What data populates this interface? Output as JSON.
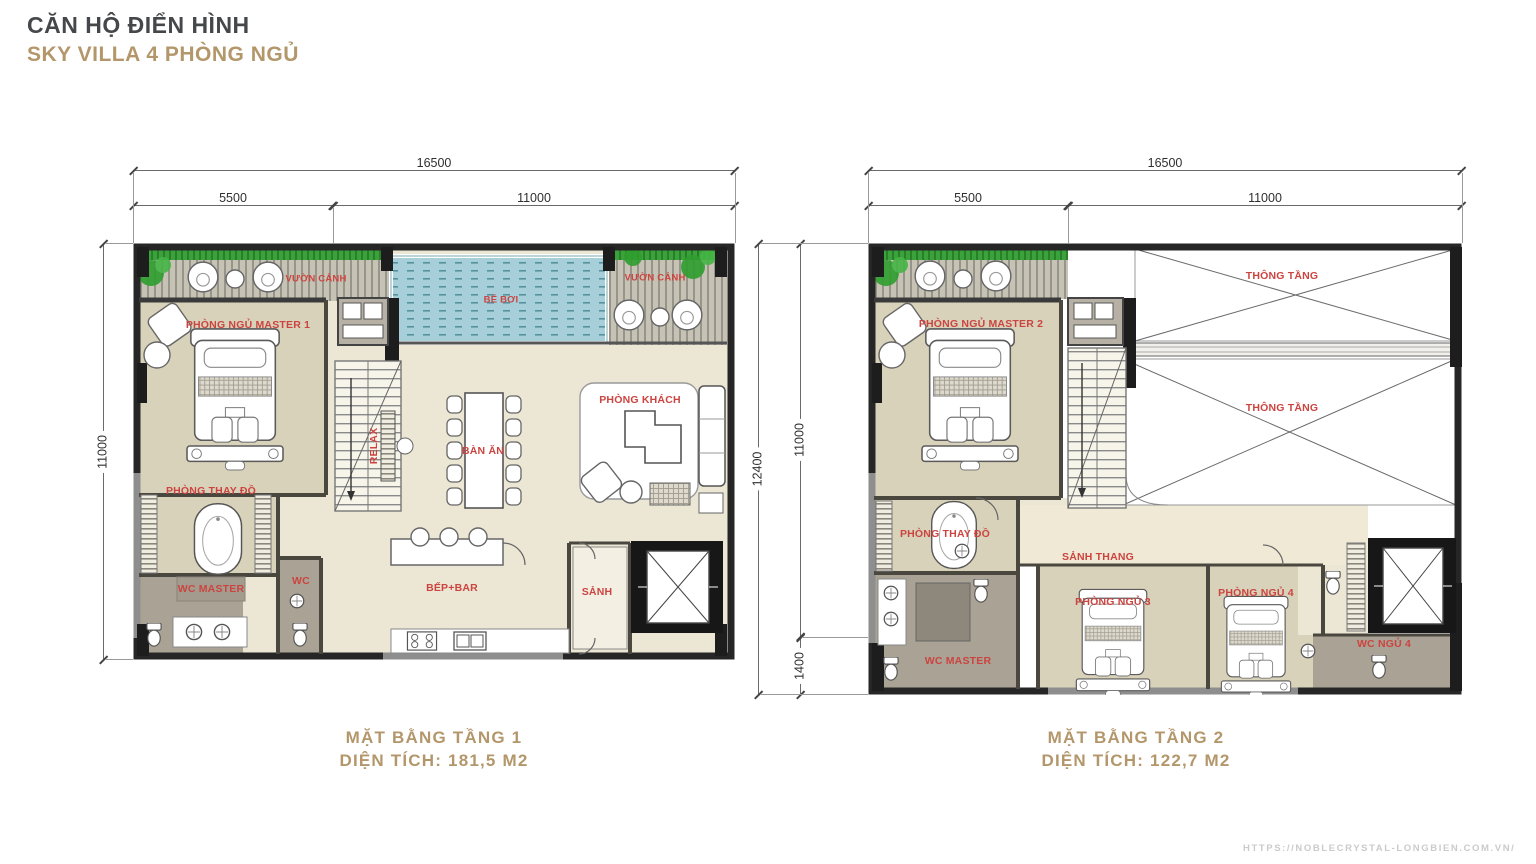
{
  "header": {
    "title": "CĂN HỘ ĐIỂN HÌNH",
    "subtitle": "SKY VILLA 4 PHÒNG NGỦ"
  },
  "plan1": {
    "dim_total_width": "16500",
    "dim_left": "5500",
    "dim_right": "11000",
    "dim_height": "11000",
    "labels": {
      "garden_left": "VƯỜN CẢNH",
      "garden_right": "VƯỜN CẢNH",
      "pool": "BỂ BƠI",
      "master_bedroom": "PHÒNG NGỦ MASTER 1",
      "dressing_room": "PHÒNG THAY ĐỒ",
      "wc_master": "WC MASTER",
      "wc": "WC",
      "relax": "RELAX",
      "dining": "BÀN ĂN",
      "living": "PHÒNG KHÁCH",
      "kitchen": "BẾP+BAR",
      "hall": "SẢNH"
    },
    "caption_title": "MẶT BẰNG TẦNG 1",
    "caption_area": "DIỆN TÍCH: 181,5 M2"
  },
  "plan2": {
    "dim_total_width": "16500",
    "dim_left": "5500",
    "dim_right": "11000",
    "dim_total_height": "12400",
    "dim_height_main": "11000",
    "dim_height_ext": "1400",
    "labels": {
      "void_upper": "THÔNG TẦNG",
      "void_lower": "THÔNG TẦNG",
      "master_bedroom": "PHÒNG NGỦ MASTER 2",
      "dressing_room": "PHÒNG THAY ĐỒ",
      "wc_master": "WC MASTER",
      "stair_hall": "SẢNH THANG",
      "bedroom_3": "PHÒNG NGỦ 3",
      "bedroom_4": "PHÒNG NGỦ 4",
      "wc_bedroom_4": "WC NGỦ 4"
    },
    "caption_title": "MẶT BẰNG TẦNG 2",
    "caption_area": "DIỆN TÍCH: 122,7 M2"
  },
  "watermark": "HTTPS://NOBLECRYSTAL-LONGBIEN.COM.VN/",
  "colors": {
    "accent_gold": "#b3976b",
    "room_label_red": "#cc4440",
    "pool_blue": "#a6cfd9",
    "floor_cream": "#ece7d4",
    "floor_tan": "#d8d2ba"
  }
}
